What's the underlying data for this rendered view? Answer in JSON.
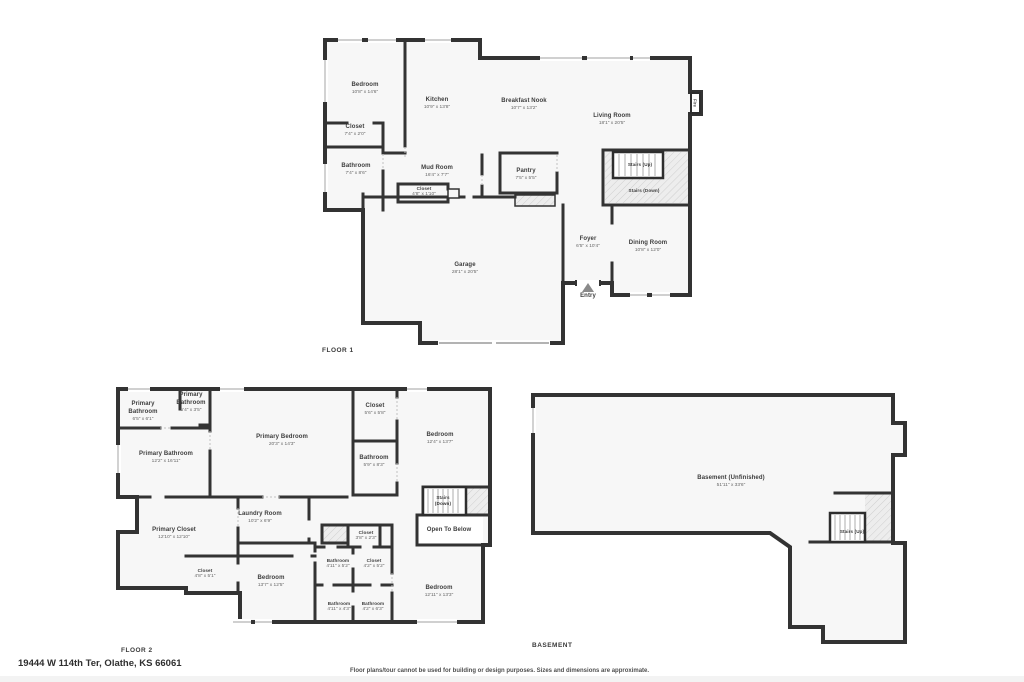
{
  "page": {
    "address": "19444 W 114th Ter, Olathe, KS 66061",
    "disclaimer": "Floor plans/tour cannot be used for building or design purposes. Sizes and dimensions are approximate."
  },
  "colors": {
    "wall": "#333333",
    "floor": "#f7f7f7",
    "hatch": "#d9d9d9",
    "text": "#3d3d3d"
  },
  "floor1": {
    "title": "FLOOR 1",
    "rooms": [
      {
        "name": "Bedroom",
        "dims": "10'8\" x 14'6\""
      },
      {
        "name": "Kitchen",
        "dims": "10'9\" x 13'8\""
      },
      {
        "name": "Breakfast Nook",
        "dims": "10'7\" x 13'2\""
      },
      {
        "name": "Living Room",
        "dims": "18'1\" x 20'5\""
      },
      {
        "name": "Closet",
        "dims": "7'4\" x 2'0\""
      },
      {
        "name": "Bathroom",
        "dims": "7'4\" x 8'6\""
      },
      {
        "name": "Mud Room",
        "dims": "16'4\" x 7'7\""
      },
      {
        "name": "Closet",
        "dims": "4'8\" x 1'10\""
      },
      {
        "name": "Pantry",
        "dims": "7'5\" x 5'5\""
      },
      {
        "name": "Foyer",
        "dims": "6'5\" x 10'4\""
      },
      {
        "name": "Dining Room",
        "dims": "10'8\" x 12'0\""
      },
      {
        "name": "Garage",
        "dims": "28'1\" x 20'5\""
      }
    ],
    "features": {
      "stairs_up": "Stairs (Up)",
      "stairs_down": "Stairs (Down)",
      "entry": "Entry",
      "fireplace": "Fire"
    }
  },
  "floor2": {
    "title": "FLOOR 2",
    "rooms": [
      {
        "name": "Primary Bathroom",
        "dims": "6'5\" x 6'1\""
      },
      {
        "name": "Primary Bathroom",
        "dims": "5'4\" x 3'5\""
      },
      {
        "name": "Primary Bathroom",
        "dims": "12'2\" x 16'11\""
      },
      {
        "name": "Primary Bedroom",
        "dims": "20'3\" x 14'3\""
      },
      {
        "name": "Closet",
        "dims": "5'6\" x 5'8\""
      },
      {
        "name": "Bathroom",
        "dims": "5'9\" x 8'3\""
      },
      {
        "name": "Bedroom",
        "dims": "12'4\" x 13'7\""
      },
      {
        "name": "Laundry Room",
        "dims": "10'2\" x 6'9\""
      },
      {
        "name": "Primary Closet",
        "dims": "12'10\" x 12'10\""
      },
      {
        "name": "Closet",
        "dims": "4'8\" x 5'1\""
      },
      {
        "name": "Closet",
        "dims": "3'8\" x 2'3\""
      },
      {
        "name": "Bedroom",
        "dims": "13'7\" x 12'5\""
      },
      {
        "name": "Bathroom",
        "dims": "4'11\" x 5'2\""
      },
      {
        "name": "Closet",
        "dims": "4'2\" x 5'2\""
      },
      {
        "name": "Bathroom",
        "dims": "4'11\" x 4'3\""
      },
      {
        "name": "Bathroom",
        "dims": "4'2\" x 6'3\""
      },
      {
        "name": "Bedroom",
        "dims": "12'11\" x 13'3\""
      }
    ],
    "features": {
      "stairs_down": "Stairs (Down)",
      "open_to_below": "Open To Below"
    }
  },
  "basement": {
    "title": "BASEMENT",
    "rooms": [
      {
        "name": "Basement (Unfinished)",
        "dims": "51'11\" x 33'6\""
      }
    ],
    "features": {
      "stairs_up": "Stairs (Up)"
    }
  }
}
